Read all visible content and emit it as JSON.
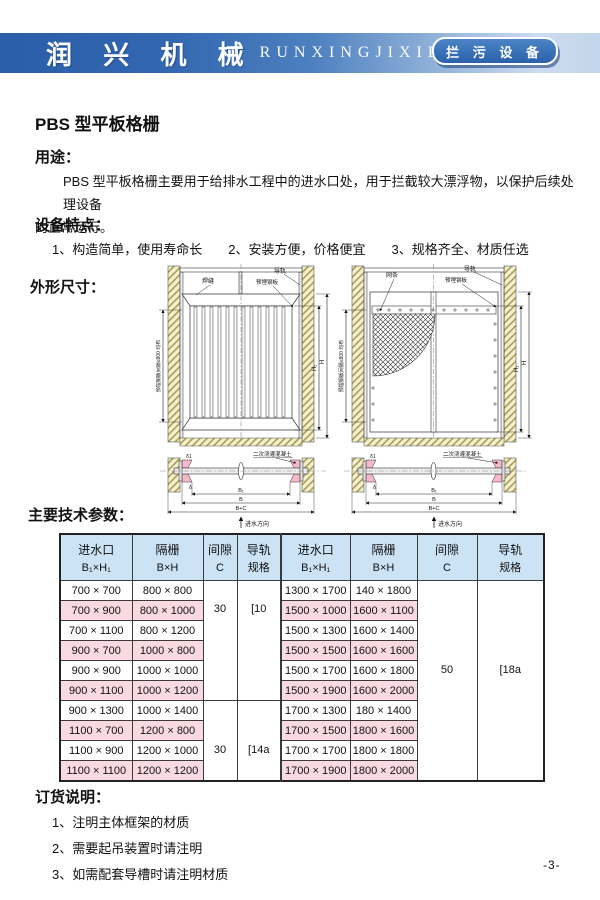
{
  "header": {
    "brand_cn": "润 兴 机 械",
    "brand_en": "RUNXINGJIXIE",
    "badge": "拦 污 设 备"
  },
  "page_title": "PBS 型平板格栅",
  "sections": {
    "usage_heading": "用途：",
    "usage_line1": "PBS 型平板格栅主要用于给排水工程中的进水口处，用于拦截较大漂浮物，以保护后续处理设备",
    "usage_line2": "的正常运行。",
    "features_heading": "设备特点：",
    "features": [
      "1、构造简单，使用寿命长",
      "2、安装方便，价格便宜",
      "3、规格齐全、材质任选"
    ],
    "dimensions_heading": "外形尺寸：",
    "params_heading": "主要技术参数：",
    "order_heading": "订货说明：",
    "order_items": [
      "1、注明主体框架的材质",
      "2、需要起吊装置时请注明",
      "3、如需配套导槽时请注明材质"
    ]
  },
  "drawing": {
    "label_weld": "焊缝",
    "label_rail": "导轨",
    "label_plate": "预埋钢板",
    "label_bars": "网条",
    "label_spacing": "预埋钢板间隔≤800 均布",
    "label_concrete": "二次浇灌混凝土",
    "label_flow": "进水方向",
    "dim_h1": "H₁",
    "dim_h": "H",
    "dim_b1": "B₁",
    "dim_b": "B",
    "dim_bc": "B+C",
    "delta1": "δ1",
    "delta": "δ"
  },
  "table": {
    "headers": [
      {
        "t": "进水口",
        "b": "B₁×H₁"
      },
      {
        "t": "隔栅",
        "b": "B×H"
      },
      {
        "t": "间隙",
        "b": "C"
      },
      {
        "t": "导轨",
        "b": "规格"
      },
      {
        "t": "进水口",
        "b": "B₁×H₁"
      },
      {
        "t": "隔栅",
        "b": "B×H"
      },
      {
        "t": "间隙",
        "b": "C"
      },
      {
        "t": "导轨",
        "b": "规格"
      }
    ],
    "gap_left_top": "30",
    "rail_left_top": "[10",
    "gap_left_bottom": "30",
    "rail_left_bottom": "[14a",
    "gap_right": "50",
    "rail_right": "[18a",
    "rows": [
      {
        "l1": "700 × 700",
        "l2": "800 × 800",
        "r1": "1300 × 1700",
        "r2": "140 × 1800"
      },
      {
        "l1": "700 × 900",
        "l2": "800 × 1000",
        "r1": "1500 × 1000",
        "r2": "1600 × 1100"
      },
      {
        "l1": "700 × 1100",
        "l2": "800 × 1200",
        "r1": "1500 × 1300",
        "r2": "1600 × 1400"
      },
      {
        "l1": "900 × 700",
        "l2": "1000 × 800",
        "r1": "1500 × 1500",
        "r2": "1600 × 1600"
      },
      {
        "l1": "900 × 900",
        "l2": "1000 × 1000",
        "r1": "1500 × 1700",
        "r2": "1600 × 1800"
      },
      {
        "l1": "900 × 1100",
        "l2": "1000 × 1200",
        "r1": "1500 × 1900",
        "r2": "1600 × 2000"
      },
      {
        "l1": "900 × 1300",
        "l2": "1000 × 1400",
        "r1": "1700 × 1300",
        "r2": "180 × 1400"
      },
      {
        "l1": "1100 × 700",
        "l2": "1200 × 800",
        "r1": "1700 × 1500",
        "r2": "1800 × 1600"
      },
      {
        "l1": "1100 × 900",
        "l2": "1200 × 1000",
        "r1": "1700 × 1700",
        "r2": "1800 × 1800"
      },
      {
        "l1": "1100 × 1100",
        "l2": "1200 × 1200",
        "r1": "1700 × 1900",
        "r2": "1800 × 2000"
      }
    ]
  },
  "footer": {
    "page_number": "-3-"
  }
}
